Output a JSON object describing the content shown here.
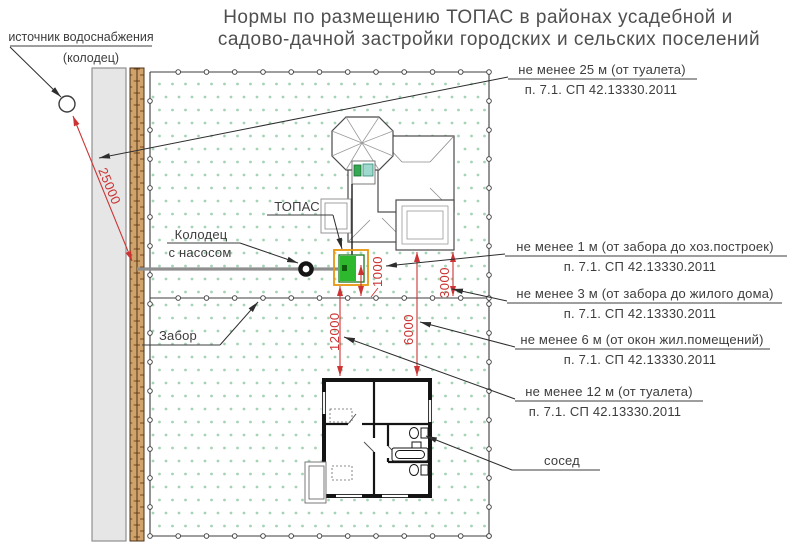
{
  "title": {
    "line1": "Нормы по размещению ТОПАС в районах усадебной и",
    "line2": "садово-дачной застройки городских и сельских поселений"
  },
  "labels": {
    "water_source_line1": "источник водоснабжения",
    "water_source_line2": "(колодец)",
    "topas": "ТОПАС",
    "well_pump_line1": "Колодец",
    "well_pump_line2": "с насосом",
    "fence": "Забор",
    "neighbor": "сосед"
  },
  "requirements": [
    {
      "text": "не менее 25 м (от туалета)",
      "norm": "п. 7.1. СП 42.13330.2011"
    },
    {
      "text": "не менее 1 м (от забора до хоз.построек)",
      "norm": "п. 7.1. СП 42.13330.2011"
    },
    {
      "text": "не менее 3 м (от забора до жилого дома)",
      "norm": "п. 7.1. СП 42.13330.2011"
    },
    {
      "text": "не менее 6 м (от окон жил.помещений)",
      "norm": "п. 7.1. СП 42.13330.2011"
    },
    {
      "text": "не менее 12 м (от туалета)",
      "norm": "п. 7.1. СП 42.13330.2011"
    }
  ],
  "dimensions": {
    "d25000": "25000",
    "d1000": "1000",
    "d3000": "3000",
    "d6000": "6000",
    "d12000": "12000"
  },
  "colors": {
    "dimension_red": "#cc3333",
    "topas_green": "#2eb82e",
    "topas_outline_orange": "#e8960f",
    "plot_dot_green": "#a5d3b5",
    "fence_wood": "#cfa36b",
    "road_gray": "#e6e6e6"
  }
}
